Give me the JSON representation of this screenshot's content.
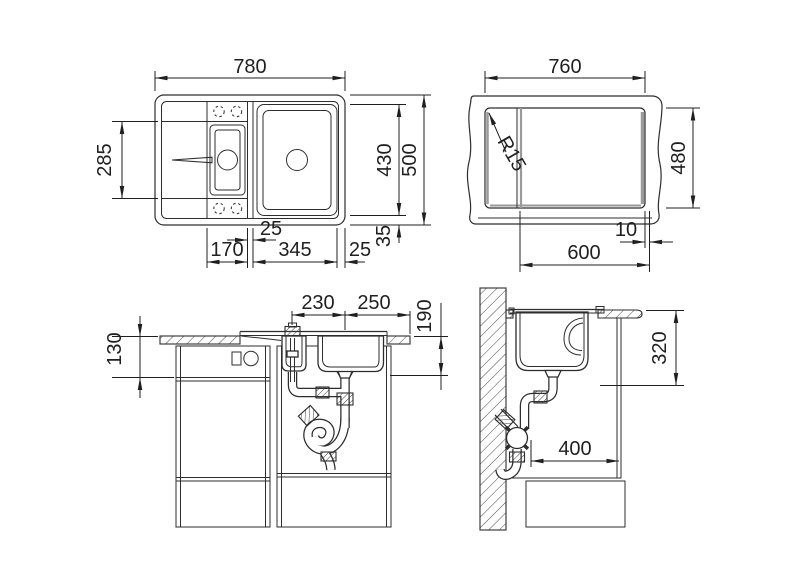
{
  "colors": {
    "line": "#2d2d2d",
    "dim": "#1f1f1f",
    "shade": "#9a9a9a",
    "background": "#ffffff"
  },
  "views": {
    "sink_top": {
      "name": "Sink top view",
      "dim_total_width": "780",
      "dim_bowl_zone_height": "285",
      "dim_bowls_length": "430",
      "dim_total_depth": "500",
      "dim_rim_gap": "35",
      "dim_bowl_divider": "25",
      "dim_drainboard": "170",
      "dim_main_bowl": "345",
      "dim_right_edge": "25"
    },
    "cutout_top": {
      "name": "Worktop cutout view",
      "dim_cutout_width": "760",
      "dim_corner_radius": "R15",
      "dim_cutout_depth": "480",
      "dim_edge_offset": "10",
      "dim_cabinet_width": "600"
    },
    "front_section": {
      "name": "Front installation view",
      "dim_small_bowl_to_divider": "230",
      "dim_divider_to_edge": "250",
      "dim_bowl_depth": "190",
      "dim_counter_to_rail": "130"
    },
    "side_section": {
      "name": "Side installation view",
      "dim_drain_height": "320",
      "dim_trap_clearance": "400"
    }
  }
}
